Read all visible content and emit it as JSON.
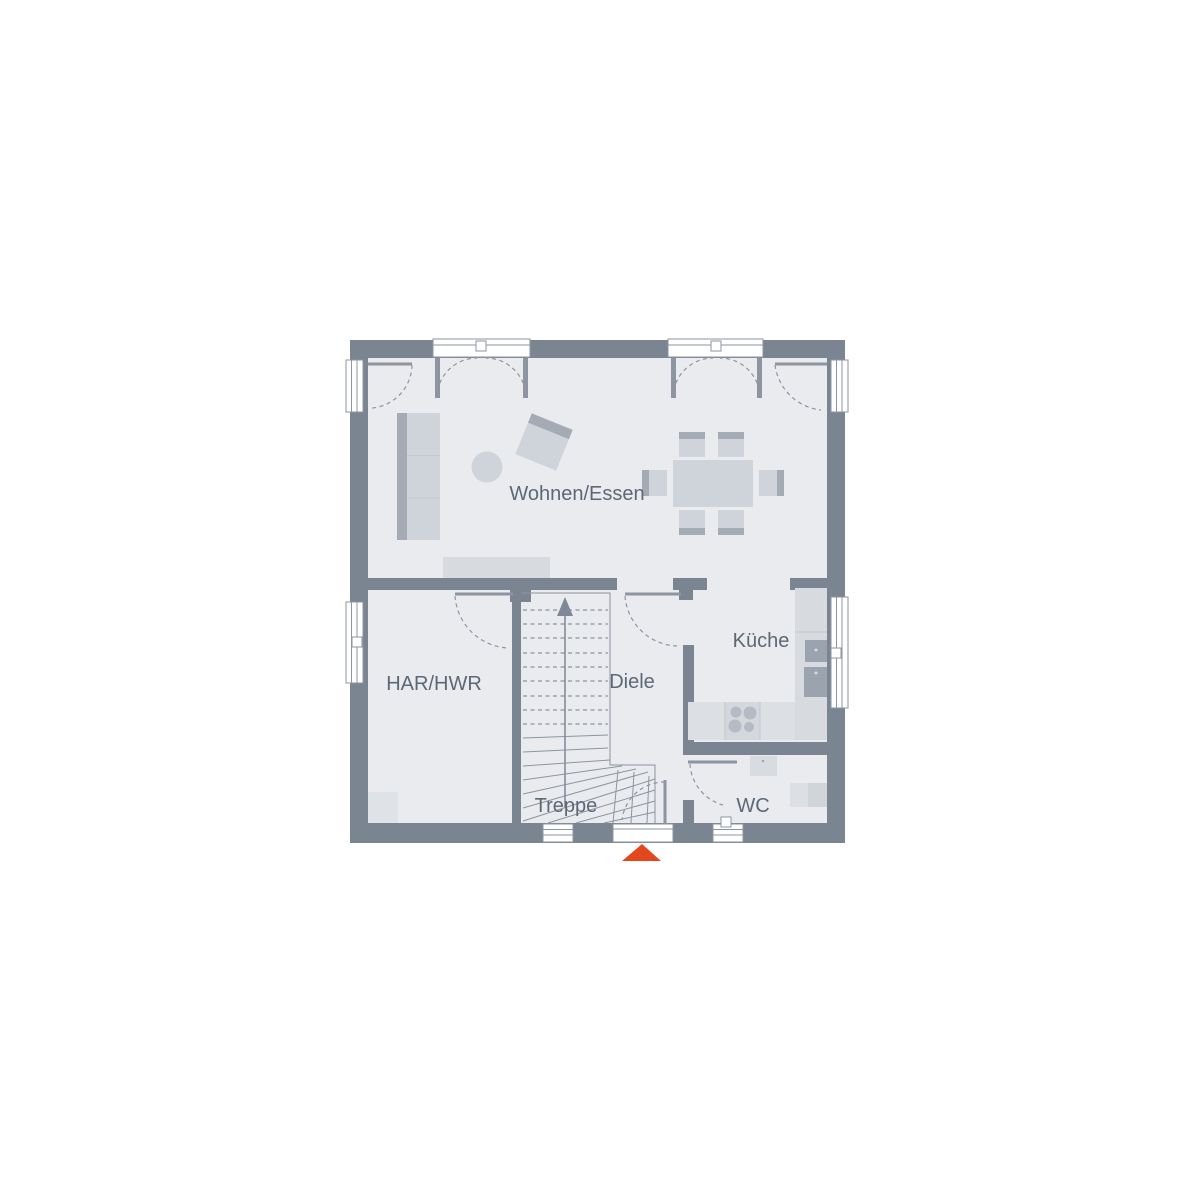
{
  "rooms": [
    {
      "id": "wohnen-essen",
      "label": "Wohnen/Essen"
    },
    {
      "id": "har-hwr",
      "label": "HAR/HWR"
    },
    {
      "id": "diele",
      "label": "Diele"
    },
    {
      "id": "kueche",
      "label": "Küche"
    },
    {
      "id": "treppe",
      "label": "Treppe"
    },
    {
      "id": "wc",
      "label": "WC"
    }
  ],
  "icons": {
    "entrance_marker": "up-triangle",
    "stair_direction": "up-arrow"
  },
  "colors": {
    "background": "#ffffff",
    "wall": "#7b8592",
    "floor": "#e9ebee",
    "line": "#8d95a1",
    "glass": "#ffffff",
    "furniture_light": "#cfd4da",
    "furniture_mid": "#d7dade",
    "furniture_dark": "#a4abb5",
    "counter": "#dcdfe3",
    "appliance_dark": "#9ba3ae",
    "burner": "#b5bbc4",
    "label_text": "#5d6876",
    "entrance_marker": "#e2471d"
  }
}
